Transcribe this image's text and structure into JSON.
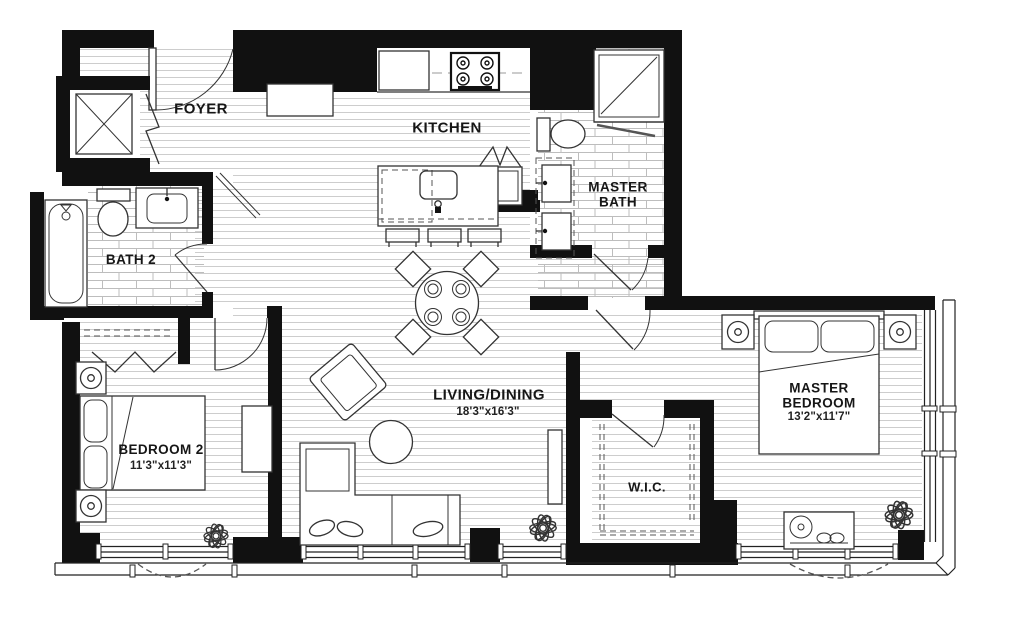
{
  "document": {
    "type": "apartment-floor-plan"
  },
  "rooms": {
    "foyer": {
      "name": "FOYER"
    },
    "kitchen": {
      "name": "KITCHEN"
    },
    "master_bath": {
      "name_line1": "MASTER",
      "name_line2": "BATH"
    },
    "bath2": {
      "name": "BATH 2"
    },
    "bedroom2": {
      "name": "BEDROOM 2",
      "dims": "11'3\"x11'3\""
    },
    "living_dining": {
      "name": "LIVING/DINING",
      "dims": "18'3\"x16'3\""
    },
    "wic": {
      "name": "W.I.C."
    },
    "master_bedroom": {
      "name_line1": "MASTER",
      "name_line2": "BEDROOM",
      "dims": "13'2\"x11'7\""
    }
  },
  "fixtures": [
    "entry-door",
    "washer-dryer",
    "console-table",
    "range-cooktop",
    "kitchen-island-sink",
    "refrigerator",
    "bar-stools",
    "dining-table",
    "armchair",
    "coffee-table",
    "sectional-sofa",
    "toilet",
    "bathtub",
    "vanity-sink",
    "shower",
    "bed",
    "nightstand-lamp",
    "dresser",
    "bench",
    "plant",
    "window-wall",
    "closet-rod",
    "bifold-door"
  ],
  "colors": {
    "wall": "#111111",
    "floor_line": "#cdcdcd",
    "tile_line": "#bdbdbd",
    "furniture_line": "#333333",
    "window_line": "#222222",
    "label": "#161616",
    "background": "#ffffff"
  }
}
